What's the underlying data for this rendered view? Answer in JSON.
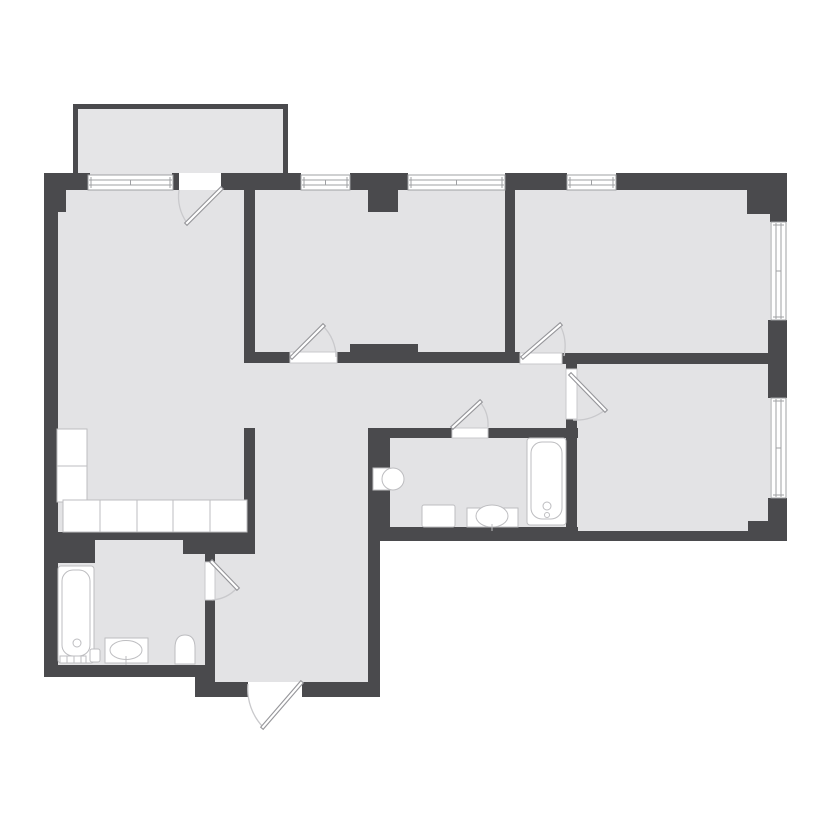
{
  "canvas": {
    "width": 828,
    "height": 828
  },
  "palette": {
    "background": "#ffffff",
    "wall": "#4a4a4d",
    "floor": "#e3e3e5",
    "balcony_floor": "#e5e5e7",
    "fixture_fill": "#ffffff",
    "fixture_stroke": "#bdbdc0",
    "window_stroke": "#9fa0a3",
    "sill_stroke": "#c9c9cc",
    "door_leaf_stroke": "#96969a",
    "door_leaf_fill": "#ffffff",
    "door_arc": "#c9c9cc"
  },
  "plan": {
    "balcony": {
      "floor": {
        "name": "balcony-floor",
        "x": 78,
        "y": 109,
        "w": 205,
        "h": 66
      },
      "walls": [
        {
          "name": "balcony-wall-top",
          "x": 73,
          "y": 104,
          "w": 215,
          "h": 5
        },
        {
          "name": "balcony-wall-left",
          "x": 73,
          "y": 104,
          "w": 5,
          "h": 69
        },
        {
          "name": "balcony-wall-right",
          "x": 283,
          "y": 104,
          "w": 5,
          "h": 69
        }
      ]
    },
    "floors": [
      {
        "name": "living-kitchen-floor",
        "x": 58,
        "y": 188,
        "w": 187,
        "h": 344
      },
      {
        "name": "middle-bedroom-floor",
        "x": 255,
        "y": 188,
        "w": 250,
        "h": 165
      },
      {
        "name": "right-room-floor",
        "x": 515,
        "y": 188,
        "w": 255,
        "h": 166
      },
      {
        "name": "corridor-floor",
        "x": 245,
        "y": 362,
        "w": 322,
        "h": 66
      },
      {
        "name": "hallway-upper-floor",
        "x": 254,
        "y": 428,
        "w": 114,
        "h": 126
      },
      {
        "name": "hallway-lower-floor",
        "x": 215,
        "y": 554,
        "w": 153,
        "h": 128
      },
      {
        "name": "bathroom-1-floor",
        "x": 58,
        "y": 540,
        "w": 147,
        "h": 125
      },
      {
        "name": "bathroom-2-floor",
        "x": 390,
        "y": 438,
        "w": 178,
        "h": 89
      },
      {
        "name": "bedroom-floor",
        "x": 577,
        "y": 364,
        "w": 193,
        "h": 167
      }
    ],
    "walls": [
      {
        "name": "wall-top-corner-left",
        "x": 44,
        "y": 173,
        "w": 46,
        "h": 17
      },
      {
        "name": "wall-top-stub",
        "x": 172,
        "y": 173,
        "w": 7,
        "h": 17
      },
      {
        "name": "wall-top-1",
        "x": 221,
        "y": 173,
        "w": 80,
        "h": 17
      },
      {
        "name": "wall-top-2",
        "x": 350,
        "y": 173,
        "w": 58,
        "h": 17
      },
      {
        "name": "wall-top-3",
        "x": 505,
        "y": 173,
        "w": 62,
        "h": 17
      },
      {
        "name": "wall-top-4",
        "x": 616,
        "y": 173,
        "w": 171,
        "h": 17
      },
      {
        "name": "wall-corner-tr",
        "x": 747,
        "y": 188,
        "w": 40,
        "h": 26
      },
      {
        "name": "wall-right-1",
        "x": 770,
        "y": 214,
        "w": 17,
        "h": 8
      },
      {
        "name": "wall-right-2",
        "x": 768,
        "y": 320,
        "w": 19,
        "h": 78
      },
      {
        "name": "wall-right-3",
        "x": 768,
        "y": 498,
        "w": 19,
        "h": 43
      },
      {
        "name": "wall-corner-br",
        "x": 748,
        "y": 521,
        "w": 22,
        "h": 20
      },
      {
        "name": "wall-bottom-bath2",
        "x": 368,
        "y": 527,
        "w": 210,
        "h": 14
      },
      {
        "name": "wall-bottom-bedroom",
        "x": 568,
        "y": 531,
        "w": 180,
        "h": 10
      },
      {
        "name": "wall-left-upper",
        "x": 44,
        "y": 173,
        "w": 22,
        "h": 39
      },
      {
        "name": "wall-left",
        "x": 44,
        "y": 212,
        "w": 14,
        "h": 465
      },
      {
        "name": "wall-left-middle",
        "x": 244,
        "y": 173,
        "w": 11,
        "h": 189
      },
      {
        "name": "wall-left-hallway",
        "x": 244,
        "y": 428,
        "w": 11,
        "h": 110
      },
      {
        "name": "wall-middle-right",
        "x": 505,
        "y": 190,
        "w": 10,
        "h": 165
      },
      {
        "name": "column-top-middle",
        "x": 368,
        "y": 190,
        "w": 30,
        "h": 22
      },
      {
        "name": "wall-corridor-1",
        "x": 244,
        "y": 352,
        "w": 46,
        "h": 11
      },
      {
        "name": "wall-corridor-2",
        "x": 337,
        "y": 352,
        "w": 183,
        "h": 11
      },
      {
        "name": "wall-corridor-thick",
        "x": 350,
        "y": 344,
        "w": 68,
        "h": 8
      },
      {
        "name": "wall-corridor-3",
        "x": 562,
        "y": 353,
        "w": 206,
        "h": 11
      },
      {
        "name": "wall-bedroom-left-top",
        "x": 566,
        "y": 364,
        "w": 11,
        "h": 5
      },
      {
        "name": "wall-bedroom-left",
        "x": 566,
        "y": 419,
        "w": 11,
        "h": 119
      },
      {
        "name": "wall-bath2-left",
        "x": 368,
        "y": 428,
        "w": 22,
        "h": 99
      },
      {
        "name": "wall-bath2-top-1",
        "x": 368,
        "y": 428,
        "w": 84,
        "h": 10
      },
      {
        "name": "wall-bath2-top-2",
        "x": 488,
        "y": 428,
        "w": 90,
        "h": 10
      },
      {
        "name": "wall-kitchen-bottom",
        "x": 44,
        "y": 532,
        "w": 146,
        "h": 8
      },
      {
        "name": "wall-hall-top-block",
        "x": 183,
        "y": 532,
        "w": 72,
        "h": 22
      },
      {
        "name": "wall-bath1-right-top",
        "x": 205,
        "y": 554,
        "w": 10,
        "h": 8
      },
      {
        "name": "wall-bath1-right",
        "x": 205,
        "y": 600,
        "w": 10,
        "h": 67
      },
      {
        "name": "wall-bath1-duct",
        "x": 58,
        "y": 538,
        "w": 37,
        "h": 25
      },
      {
        "name": "wall-bath1-bottom",
        "x": 44,
        "y": 665,
        "w": 171,
        "h": 12
      },
      {
        "name": "wall-hall-corner",
        "x": 195,
        "y": 667,
        "w": 20,
        "h": 30
      },
      {
        "name": "wall-hall-bottom-left",
        "x": 195,
        "y": 682,
        "w": 53,
        "h": 15
      },
      {
        "name": "wall-hall-bottom-right",
        "x": 302,
        "y": 682,
        "w": 78,
        "h": 15
      },
      {
        "name": "wall-hall-right",
        "x": 368,
        "y": 538,
        "w": 12,
        "h": 159
      }
    ],
    "windows": [
      {
        "name": "window-living",
        "x": 88,
        "y": 175,
        "w": 85,
        "h": 15,
        "orient": "h"
      },
      {
        "name": "window-middle-left",
        "x": 301,
        "y": 175,
        "w": 49,
        "h": 15,
        "orient": "h"
      },
      {
        "name": "window-middle-right",
        "x": 408,
        "y": 175,
        "w": 97,
        "h": 15,
        "orient": "h"
      },
      {
        "name": "window-right-room-top",
        "x": 567,
        "y": 175,
        "w": 49,
        "h": 15,
        "orient": "h"
      },
      {
        "name": "window-right-room-side",
        "x": 771,
        "y": 222,
        "w": 15,
        "h": 98,
        "orient": "v"
      },
      {
        "name": "window-bedroom-side",
        "x": 771,
        "y": 398,
        "w": 15,
        "h": 100,
        "orient": "v"
      }
    ],
    "openings": [
      {
        "name": "balcony-door-opening",
        "x": 179,
        "y": 173,
        "w": 42,
        "h": 17
      },
      {
        "name": "entrance-opening",
        "x": 248,
        "y": 682,
        "w": 54,
        "h": 15
      }
    ],
    "door_sills": [
      {
        "name": "sill-middle-room-door",
        "x": 290,
        "y": 352,
        "w": 47,
        "h": 11
      },
      {
        "name": "sill-right-room-door",
        "x": 520,
        "y": 353,
        "w": 42,
        "h": 11
      },
      {
        "name": "sill-bedroom-door",
        "x": 566,
        "y": 369,
        "w": 11,
        "h": 50
      },
      {
        "name": "sill-bathroom2-door",
        "x": 452,
        "y": 428,
        "w": 36,
        "h": 10
      },
      {
        "name": "sill-bathroom1-door",
        "x": 205,
        "y": 562,
        "w": 10,
        "h": 38
      }
    ],
    "doors": [
      {
        "name": "balcony-door",
        "leaf": [
          221,
          189,
          187,
          223
        ],
        "arc": "M 187 223 A 45 45 0 0 1 179 190"
      },
      {
        "name": "middle-room-door",
        "leaf": [
          292,
          357,
          323,
          326
        ],
        "arc": "M 323 326 A 44 44 0 0 1 336 357"
      },
      {
        "name": "right-room-door",
        "leaf": [
          523,
          357,
          560,
          325
        ],
        "arc": "M 560 325 A 46 46 0 0 1 564 356"
      },
      {
        "name": "bedroom-door",
        "leaf": [
          571,
          375,
          605,
          410
        ],
        "arc": "M 605 410 A 47 47 0 0 1 573 420"
      },
      {
        "name": "bathroom2-door",
        "leaf": [
          453,
          427,
          480,
          402
        ],
        "arc": "M 480 402 A 36 36 0 0 1 488 427"
      },
      {
        "name": "bathroom1-door",
        "leaf": [
          212,
          562,
          237,
          588
        ],
        "arc": "M 237 588 A 37 37 0 0 1 212 600"
      },
      {
        "name": "entrance-door",
        "leaf": [
          301,
          683,
          263,
          727
        ],
        "arc": "M 263 727 A 55 55 0 0 1 248 684"
      }
    ],
    "fixtures": [
      {
        "name": "kitchen-counter",
        "shapes": [
          {
            "t": "rect",
            "x": 57,
            "y": 429,
            "w": 30,
            "h": 37
          },
          {
            "t": "rect",
            "x": 57,
            "y": 466,
            "w": 30,
            "h": 36
          },
          {
            "t": "rect",
            "x": 63,
            "y": 500,
            "w": 37,
            "h": 32
          },
          {
            "t": "rect",
            "x": 100,
            "y": 500,
            "w": 37,
            "h": 32
          },
          {
            "t": "rect",
            "x": 137,
            "y": 500,
            "w": 36,
            "h": 32
          },
          {
            "t": "rect",
            "x": 173,
            "y": 500,
            "w": 37,
            "h": 32
          },
          {
            "t": "rect",
            "x": 210,
            "y": 500,
            "w": 37,
            "h": 32
          }
        ]
      },
      {
        "name": "bathtub-1",
        "shapes": [
          {
            "t": "rect",
            "x": 58,
            "y": 566,
            "w": 36,
            "h": 97,
            "rx": 3
          },
          {
            "t": "rect",
            "x": 62,
            "y": 570,
            "w": 28,
            "h": 86,
            "rx": 11,
            "fill": "none"
          },
          {
            "t": "circle",
            "cx": 77,
            "cy": 643,
            "r": 4,
            "fill": "none"
          },
          {
            "t": "rect",
            "x": 90,
            "y": 649,
            "w": 10,
            "h": 13,
            "rx": 2
          },
          {
            "t": "rect",
            "x": 60,
            "y": 656,
            "w": 26,
            "h": 7
          },
          {
            "t": "line",
            "x1": 67,
            "y1": 656,
            "x2": 67,
            "y2": 663
          },
          {
            "t": "line",
            "x1": 74,
            "y1": 656,
            "x2": 74,
            "y2": 663
          },
          {
            "t": "line",
            "x1": 81,
            "y1": 656,
            "x2": 81,
            "y2": 663
          }
        ]
      },
      {
        "name": "sink-1",
        "shapes": [
          {
            "t": "rect",
            "x": 105,
            "y": 638,
            "w": 43,
            "h": 25
          },
          {
            "t": "ellipse",
            "cx": 126,
            "cy": 650,
            "rx": 16,
            "ry": 9.5,
            "fill": "none"
          },
          {
            "t": "line",
            "x1": 126,
            "y1": 656,
            "x2": 126,
            "y2": 665
          }
        ]
      },
      {
        "name": "toilet-1",
        "shapes": [
          {
            "t": "path",
            "d": "M 175 664 L 175 648 Q 175 635 185 635 Q 195 635 195 648 L 195 664 Z"
          }
        ]
      },
      {
        "name": "bathtub-2",
        "shapes": [
          {
            "t": "rect",
            "x": 527,
            "y": 438,
            "w": 39,
            "h": 87,
            "rx": 3
          },
          {
            "t": "rect",
            "x": 531,
            "y": 442,
            "w": 31,
            "h": 77,
            "rx": 11,
            "fill": "none"
          },
          {
            "t": "circle",
            "cx": 547,
            "cy": 506,
            "r": 4,
            "fill": "none"
          },
          {
            "t": "circle",
            "cx": 547,
            "cy": 515,
            "r": 2.5,
            "fill": "none"
          }
        ]
      },
      {
        "name": "toilet-2",
        "shapes": [
          {
            "t": "rect",
            "x": 373,
            "y": 468,
            "w": 17,
            "h": 22
          },
          {
            "t": "ellipse",
            "cx": 393,
            "cy": 479,
            "rx": 11,
            "ry": 11
          }
        ]
      },
      {
        "name": "washing-machine",
        "shapes": [
          {
            "t": "rect",
            "x": 422,
            "y": 505,
            "w": 33,
            "h": 22,
            "rx": 2
          }
        ]
      },
      {
        "name": "sink-2",
        "shapes": [
          {
            "t": "rect",
            "x": 467,
            "y": 508,
            "w": 51,
            "h": 19
          },
          {
            "t": "ellipse",
            "cx": 492,
            "cy": 516,
            "rx": 16,
            "ry": 11
          },
          {
            "t": "line",
            "x1": 492,
            "y1": 524,
            "x2": 492,
            "y2": 531
          }
        ]
      }
    ]
  }
}
